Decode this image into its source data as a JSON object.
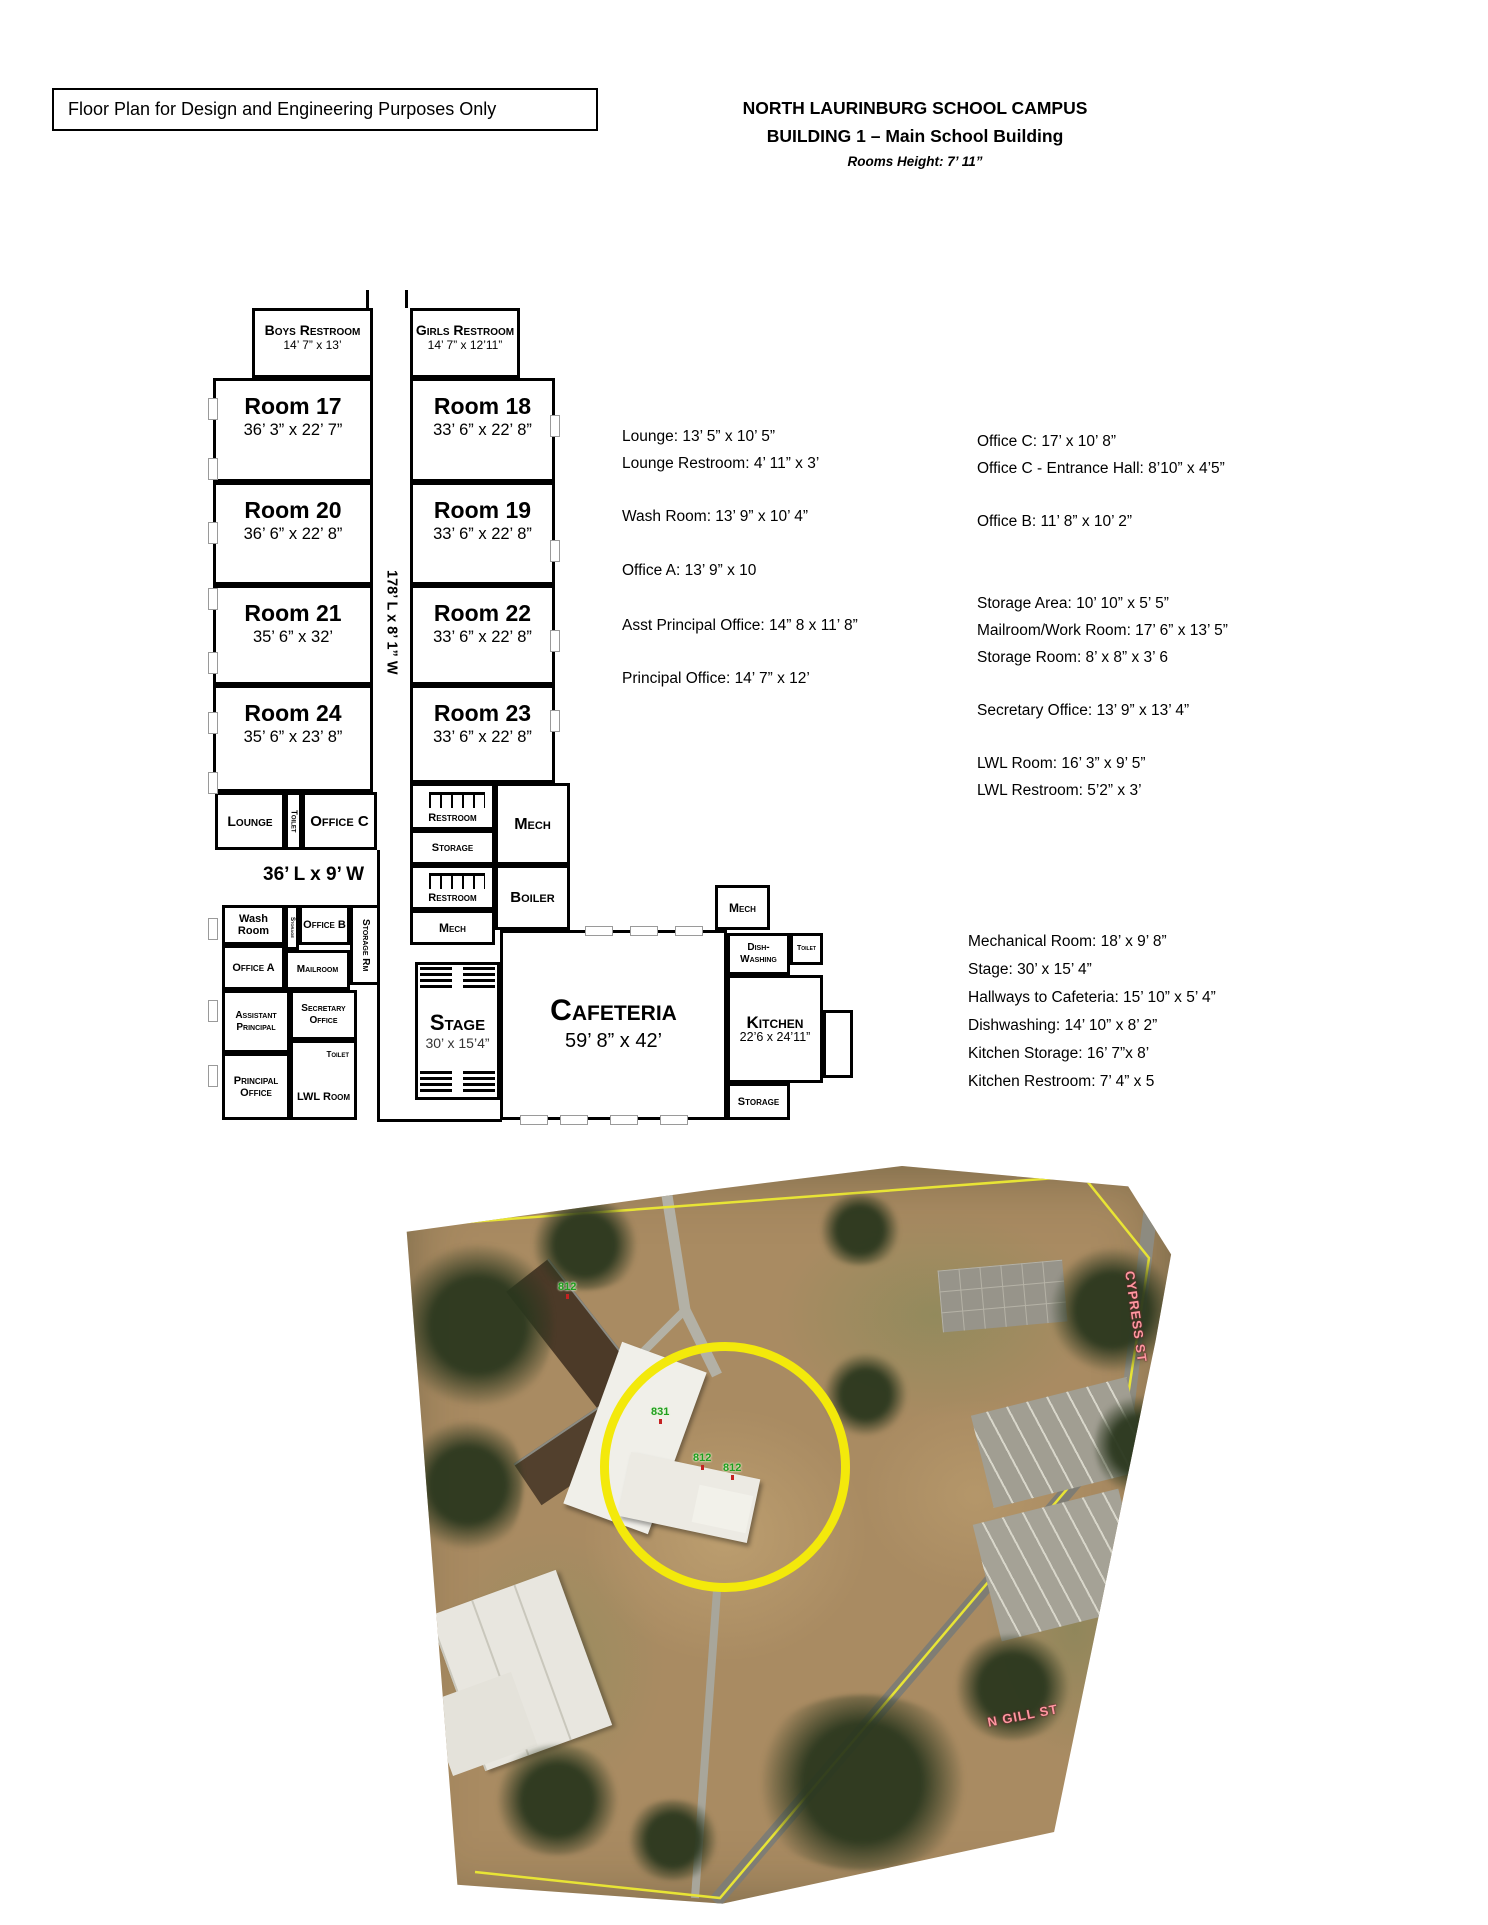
{
  "header": {
    "disclaimer": "Floor Plan for Design and Engineering Purposes Only",
    "campus_title": "NORTH LAURINBURG SCHOOL CAMPUS",
    "building_title": "BUILDING 1 – Main School Building",
    "rooms_height": "Rooms Height: 7’ 11”"
  },
  "plan": {
    "hallway_main": "178’ L x 8’ 1” W",
    "hallway_lounge": "36’ L x 9’ W",
    "rooms": {
      "boys_restroom": {
        "name": "Boys Restroom",
        "dims": "14’ 7” x 13’"
      },
      "girls_restroom": {
        "name": "Girls Restroom",
        "dims": "14’ 7” x 12’11”"
      },
      "room17": {
        "name": "Room 17",
        "dims": "36’ 3” x 22’ 7”"
      },
      "room18": {
        "name": "Room 18",
        "dims": "33’ 6” x 22’ 8”"
      },
      "room20": {
        "name": "Room 20",
        "dims": "36’ 6” x 22’ 8”"
      },
      "room19": {
        "name": "Room 19",
        "dims": "33’ 6” x 22’ 8”"
      },
      "room21": {
        "name": "Room 21",
        "dims": "35’ 6” x 32’"
      },
      "room22": {
        "name": "Room 22",
        "dims": "33’ 6” x 22’ 8”"
      },
      "room24": {
        "name": "Room 24",
        "dims": "35’ 6” x 23’ 8”"
      },
      "room23": {
        "name": "Room 23",
        "dims": "33’ 6” x 22’ 8”"
      },
      "lounge": {
        "name": "Lounge"
      },
      "toilet_lounge": {
        "name": "Toilet"
      },
      "office_c": {
        "name": "Office C"
      },
      "restroom_top": {
        "name": "Restroom"
      },
      "storage_mid": {
        "name": "Storage"
      },
      "restroom_bottom": {
        "name": "Restroom"
      },
      "mech_small": {
        "name": "Mech"
      },
      "mech_main": {
        "name": "Mech"
      },
      "boiler": {
        "name": "Boiler"
      },
      "wash_room": {
        "name": "Wash Room"
      },
      "storage_small": {
        "name": "Storage"
      },
      "office_b": {
        "name": "Office B"
      },
      "storage_rm": {
        "name": "Storage Rm"
      },
      "office_a": {
        "name": "Office A"
      },
      "mailroom": {
        "name": "Mailroom"
      },
      "assistant_principal": {
        "name": "Assistant Principal"
      },
      "secretary_office": {
        "name": "Secretary Office"
      },
      "principal_office": {
        "name": "Principal Office"
      },
      "toilet_lwl": {
        "name": "Toilet"
      },
      "lwl_room": {
        "name": "LWL Room"
      },
      "stage": {
        "name": "Stage",
        "dims": "30’ x 15’4”"
      },
      "cafeteria": {
        "name": "Cafeteria",
        "dims": "59’ 8” x 42’"
      },
      "kitchen_mech": {
        "name": "Mech"
      },
      "dishwashing": {
        "name": "Dish- Washing"
      },
      "toilet_kitchen": {
        "name": "Toilet"
      },
      "kitchen": {
        "name": "Kitchen",
        "dims": "22’6 x 24’11”"
      },
      "kitchen_storage": {
        "name": "Storage"
      }
    }
  },
  "notes": {
    "col1": [
      "Lounge:  13’ 5” x 10’ 5”",
      "Lounge Restroom:  4’ 11” x 3’",
      "Wash Room: 13’ 9” x 10’ 4”",
      "Office A:  13’ 9” x 10",
      "Asst Principal Office: 14” 8 x 11’ 8”",
      "Principal Office:  14’ 7” x 12’"
    ],
    "col2": [
      "Office C: 17’ x 10’ 8”",
      "Office C - Entrance Hall: 8’10” x 4’5”",
      "Office B:  11’ 8” x 10’ 2”",
      "Storage Area: 10’ 10” x 5’ 5”",
      "Mailroom/Work Room:  17’ 6” x 13’ 5”",
      "Storage Room:  8’ x 8” x 3’ 6",
      "Secretary Office:  13’ 9” x 13’ 4”",
      "LWL Room: 16’ 3” x 9’ 5”",
      "LWL Restroom:  5’2” x 3’"
    ],
    "col3": [
      "Mechanical Room: 18’ x 9’ 8”",
      "Stage: 30’ x 15’ 4”",
      "Hallways to Cafeteria: 15’ 10” x 5’ 4”",
      "Dishwashing: 14’ 10” x 8’ 2”",
      "Kitchen Storage: 16’ 7”x 8’",
      "Kitchen Restroom: 7’ 4” x 5"
    ]
  },
  "aerial": {
    "markers": [
      "812",
      "812",
      "831",
      "812",
      "812"
    ],
    "streets": {
      "right": "CYPRESS ST",
      "bottom": "N GILL ST"
    },
    "highlight_color": "#f3e90b"
  }
}
